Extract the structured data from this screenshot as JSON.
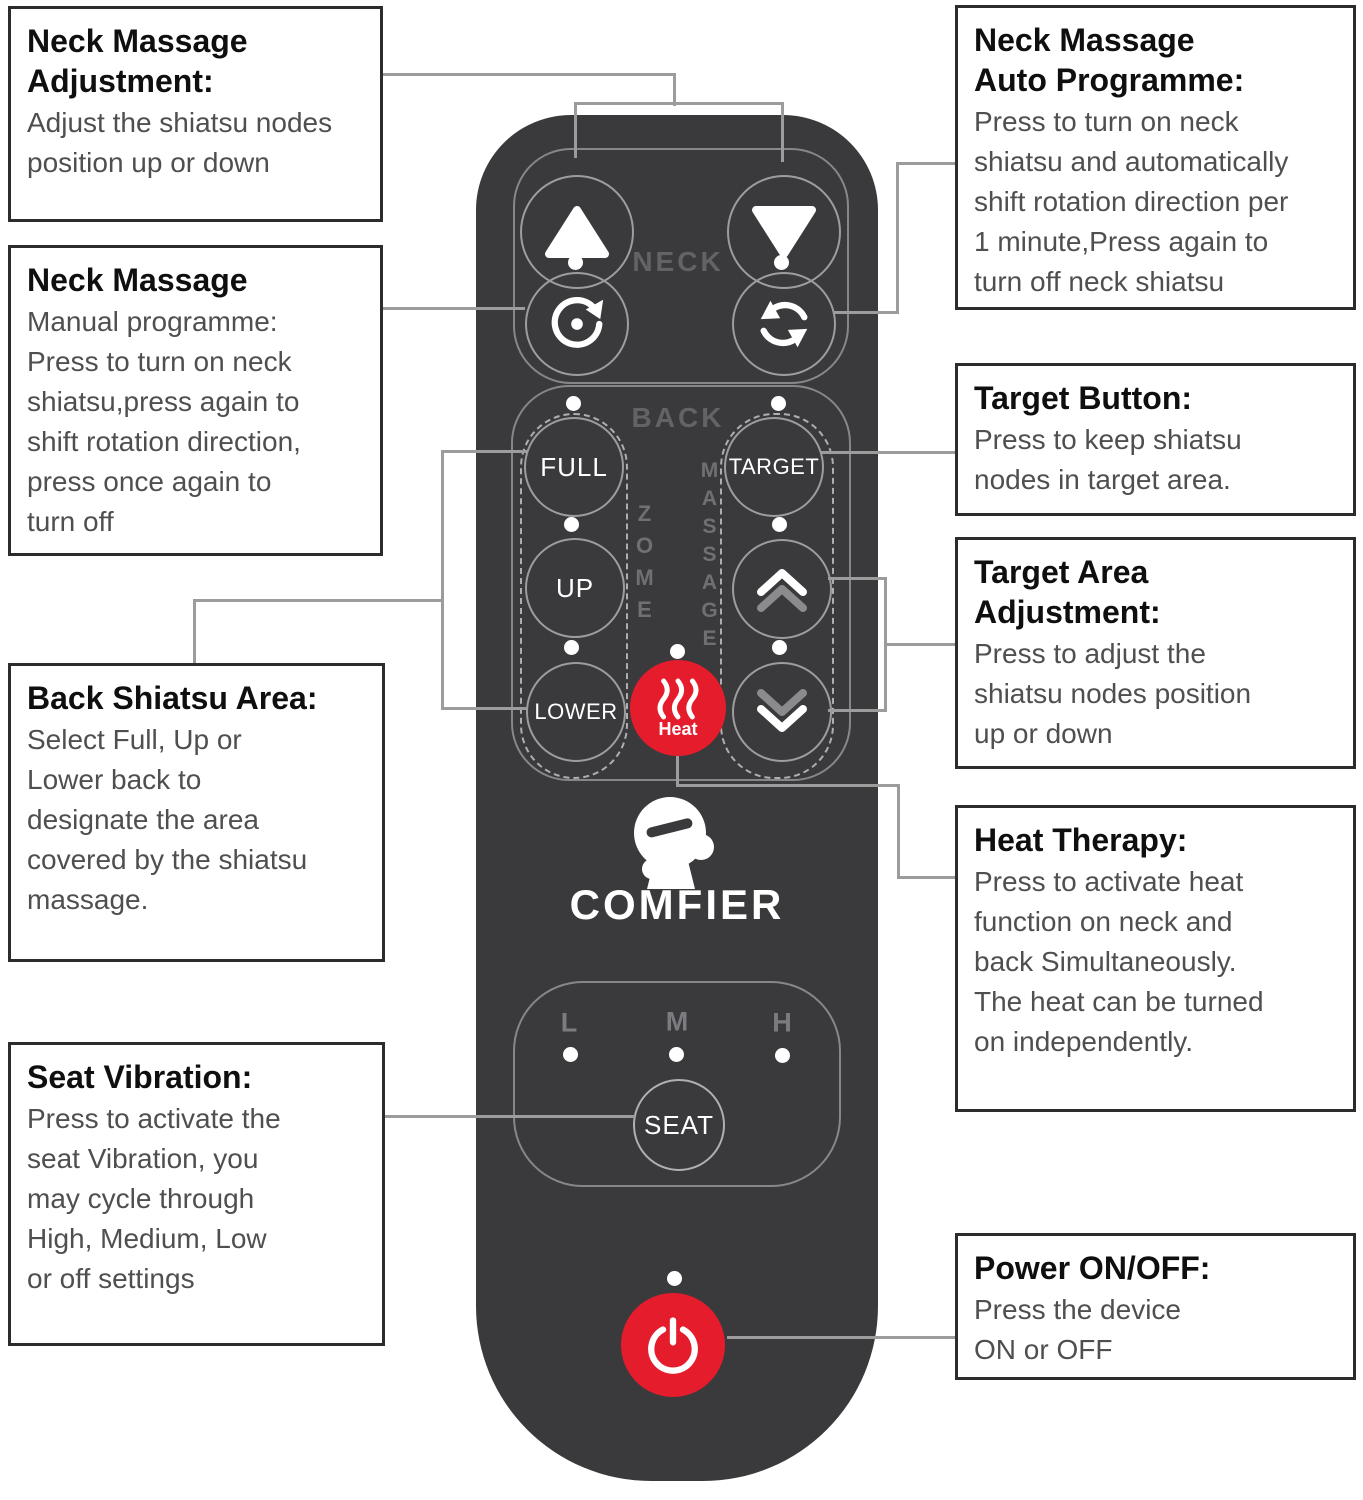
{
  "colors": {
    "remote_body": "#3a3a3c",
    "accent_red": "#e51c2c",
    "connector_gray": "#9c9c9c"
  },
  "remote": {
    "brand": "COMFIER",
    "neck": {
      "label": "NECK"
    },
    "back": {
      "label": "BACK",
      "zone_vertical_text": "ZOME",
      "massage_vertical_text": "MASSAGE",
      "full": "FULL",
      "up": "UP",
      "lower": "LOWER",
      "target": "TARGET",
      "heat": "Heat"
    },
    "seat": {
      "label": "SEAT",
      "levels": [
        "L",
        "M",
        "H"
      ]
    }
  },
  "callouts": {
    "left": [
      {
        "title": "Neck Massage\nAdjustment:",
        "body": "Adjust the shiatsu nodes\nposition up or down"
      },
      {
        "title": "Neck Massage",
        "body": "Manual programme:\nPress to turn on neck\nshiatsu,press again to\nshift rotation direction,\npress once again to\nturn off"
      },
      {
        "title": "Back Shiatsu Area:",
        "body": "Select Full, Up or\nLower back to\ndesignate the area\ncovered by the shiatsu\nmassage."
      },
      {
        "title": "Seat Vibration:",
        "body": "Press to activate the\nseat Vibration, you\nmay cycle through\nHigh, Medium, Low\nor off settings"
      }
    ],
    "right": [
      {
        "title": "Neck Massage\nAuto Programme:",
        "body": "Press to turn on neck\nshiatsu and automatically\nshift rotation direction per\n1 minute,Press again to\nturn off neck shiatsu"
      },
      {
        "title": "Target Button:",
        "body": "Press to keep shiatsu\nnodes in target area."
      },
      {
        "title": "Target Area\nAdjustment:",
        "body": "Press to adjust the\nshiatsu nodes position\nup or down"
      },
      {
        "title": "Heat Therapy:",
        "body": "Press to activate heat\nfunction on neck and\nback Simultaneously.\nThe heat can be turned\non independently."
      },
      {
        "title": "Power ON/OFF:",
        "body": "Press the device\nON or OFF"
      }
    ]
  }
}
